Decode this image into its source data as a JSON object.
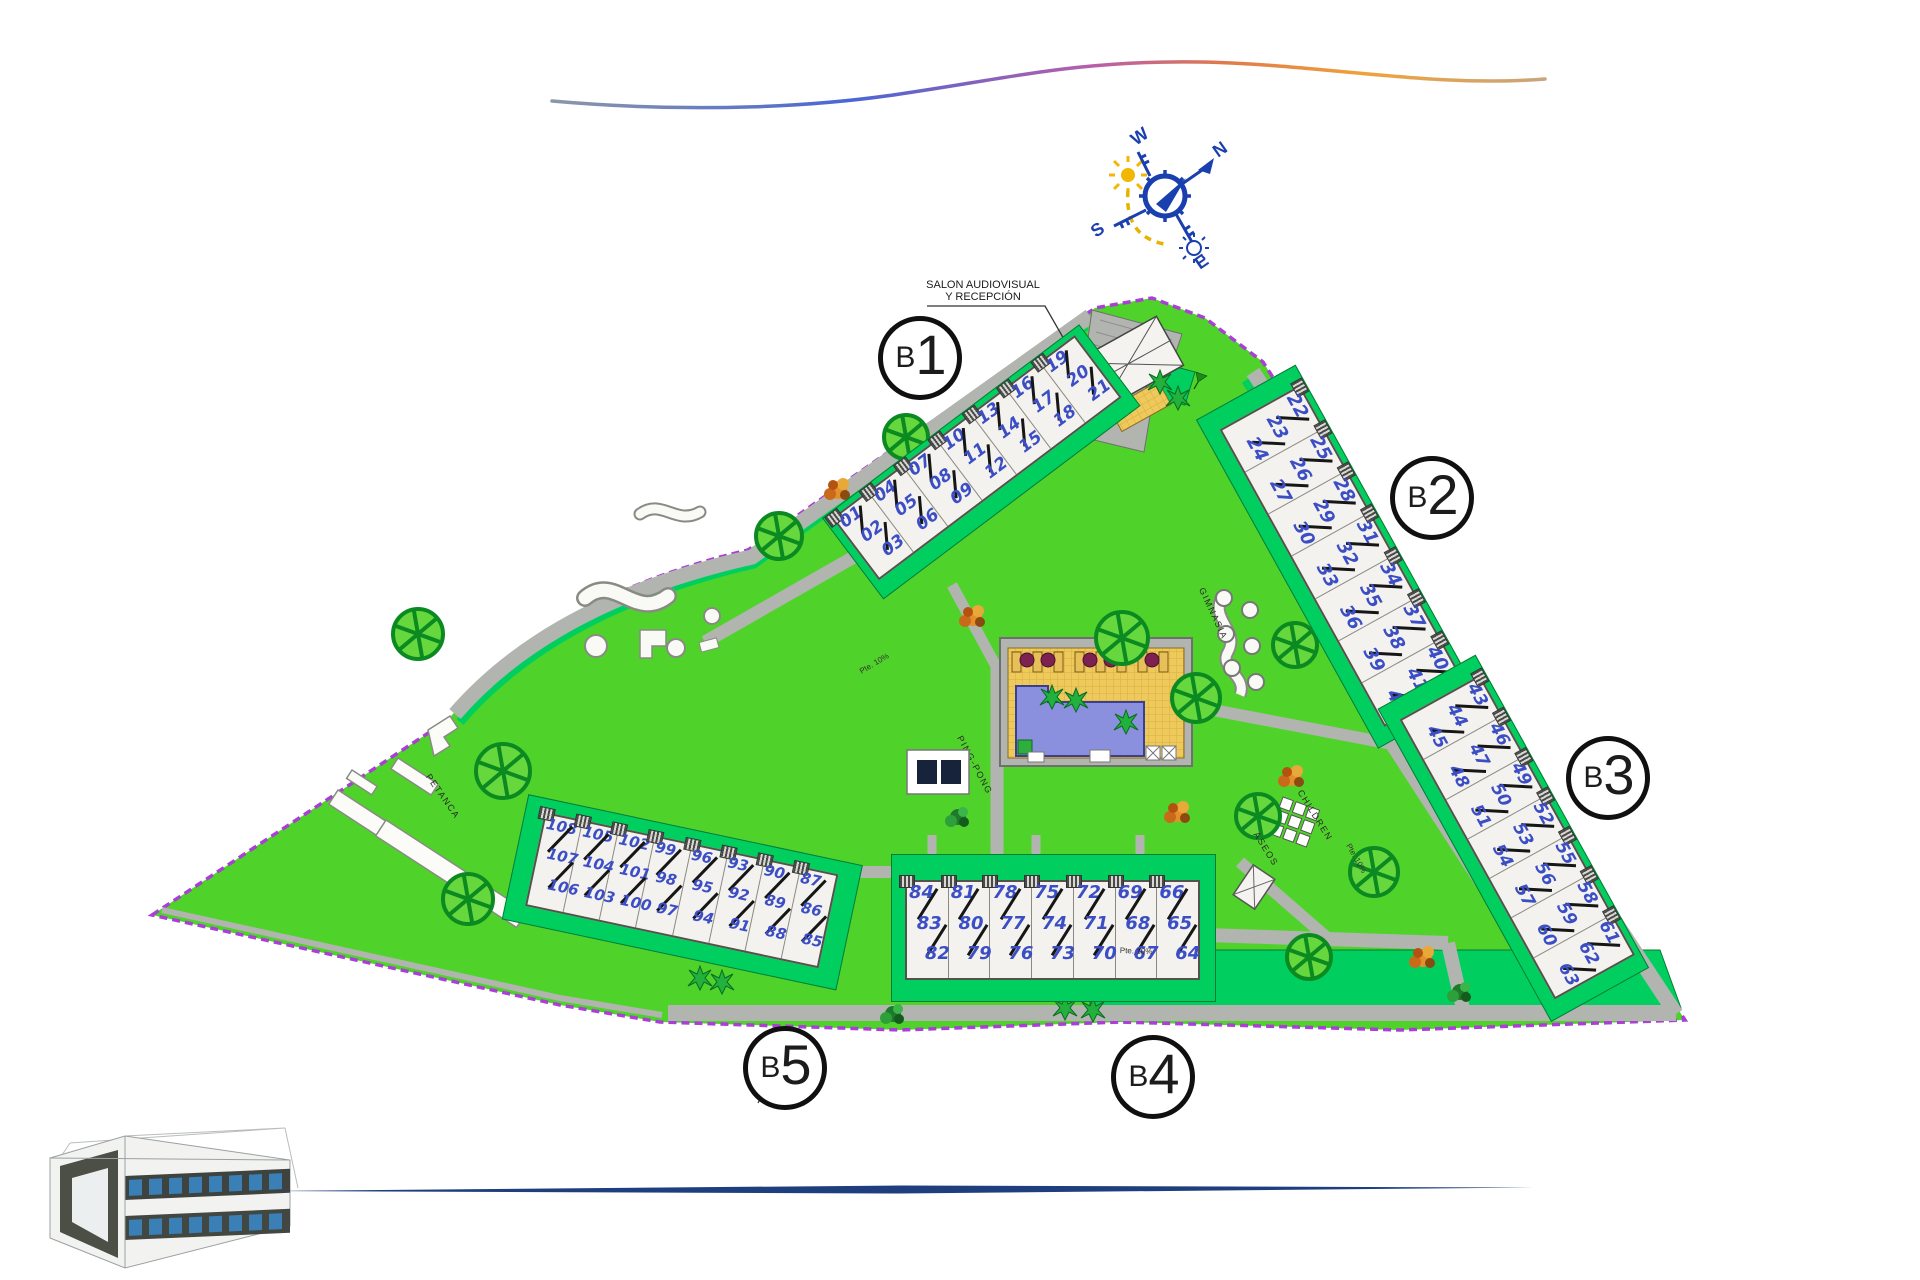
{
  "title": "Residential complex site plan",
  "compass": {
    "n": "N",
    "s": "S",
    "e": "E",
    "w": "W"
  },
  "callout": {
    "line1": "SALON AUDIOVISUAL",
    "line2": "Y RECEPCIÓN"
  },
  "areas": {
    "petanca": "PETANCA",
    "pingpong": "PING-PONG",
    "gimnasia": "GIMNASIA",
    "children": "CHILDREN",
    "aseos": "ASEOS"
  },
  "annotations": {
    "ramp": "Pte. 10%"
  },
  "blocks": [
    {
      "id": "B1",
      "label_prefix": "B",
      "label_digit": "1",
      "units": [
        [
          "01",
          "02",
          "03"
        ],
        [
          "04",
          "05",
          "06"
        ],
        [
          "07",
          "08",
          "09"
        ],
        [
          "10",
          "11",
          "12"
        ],
        [
          "13",
          "14",
          "15"
        ],
        [
          "16",
          "17",
          "18"
        ],
        [
          "19",
          "20",
          "21"
        ]
      ]
    },
    {
      "id": "B2",
      "label_prefix": "B",
      "label_digit": "2",
      "units": [
        [
          "22",
          "23",
          "24"
        ],
        [
          "25",
          "26",
          "27"
        ],
        [
          "28",
          "29",
          "30"
        ],
        [
          "31",
          "32",
          "33"
        ],
        [
          "34",
          "35",
          "36"
        ],
        [
          "37",
          "38",
          "39"
        ],
        [
          "40",
          "41",
          "42"
        ]
      ]
    },
    {
      "id": "B3",
      "label_prefix": "B",
      "label_digit": "3",
      "units": [
        [
          "43",
          "44",
          "45"
        ],
        [
          "46",
          "47",
          "48"
        ],
        [
          "49",
          "50",
          "51"
        ],
        [
          "52",
          "53",
          "54"
        ],
        [
          "55",
          "56",
          "57"
        ],
        [
          "58",
          "59",
          "60"
        ],
        [
          "61",
          "62",
          "63"
        ]
      ]
    },
    {
      "id": "B4",
      "label_prefix": "B",
      "label_digit": "4",
      "units": [
        [
          "84",
          "83",
          "82"
        ],
        [
          "81",
          "80",
          "79"
        ],
        [
          "78",
          "77",
          "76"
        ],
        [
          "75",
          "74",
          "73"
        ],
        [
          "72",
          "71",
          "70"
        ],
        [
          "69",
          "68",
          "67"
        ],
        [
          "66",
          "65",
          "64"
        ]
      ]
    },
    {
      "id": "B5",
      "label_prefix": "B",
      "label_digit": "5",
      "units": [
        [
          "108",
          "107",
          "106"
        ],
        [
          "105",
          "104",
          "103"
        ],
        [
          "102",
          "101",
          "100"
        ],
        [
          "99",
          "98",
          "97"
        ],
        [
          "96",
          "95",
          "94"
        ],
        [
          "93",
          "92",
          "91"
        ],
        [
          "90",
          "89",
          "88"
        ],
        [
          "87",
          "86",
          "85"
        ]
      ]
    }
  ],
  "colors": {
    "lawn": "#4fd32a",
    "garden": "#00cf60",
    "path": "#b2b4b0",
    "boundary": "#a93fd4",
    "building": "#f3f2ee",
    "unit_number": "#3c4ec5",
    "pool_water": "#8a90dd",
    "pool_deck": "#eec95c",
    "tree": "#0c8a22",
    "compass_blue": "#1a3fae",
    "sun": "#f2b705",
    "bottom_line": "#1e3e7e"
  }
}
